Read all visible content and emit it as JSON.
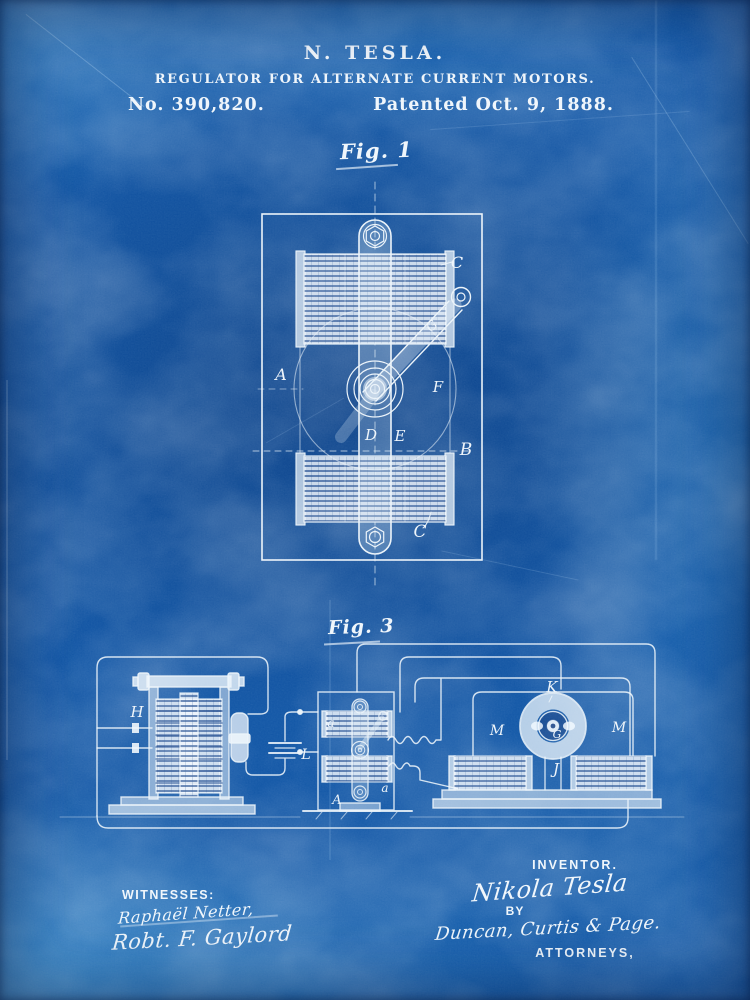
{
  "header": {
    "inventor": "N. TESLA.",
    "title": "REGULATOR FOR ALTERNATE CURRENT MOTORS.",
    "patent_number": "No. 390,820.",
    "patent_date": "Patented Oct. 9, 1888."
  },
  "fig1": {
    "caption": "Fig. 1",
    "labels": {
      "c_top": "C",
      "g": "G",
      "a": "A",
      "f": "F",
      "d": "D",
      "e": "E",
      "b": "B",
      "c_bottom": "C"
    }
  },
  "fig3": {
    "caption": "Fig. 3",
    "labels": {
      "h": "H",
      "l": "L",
      "a_top": "a",
      "a_bottom": "a",
      "a_cap": "A",
      "k": "K",
      "m_left": "M",
      "m_right": "M",
      "g": "G",
      "j": "J"
    }
  },
  "footer": {
    "witnesses_heading": "WITNESSES:",
    "witness_signature_1": "Raphaël Netter,",
    "witness_signature_2": "Robt. F. Gaylord",
    "inventor_heading": "INVENTOR.",
    "inventor_signature": "Nikola Tesla",
    "by_label": "BY",
    "attorney_signature": "Duncan, Curtis & Page.",
    "attorneys_heading": "ATTORNEYS,"
  },
  "colors": {
    "paper_blue": "#1156a6",
    "paper_light": "#4fa3d8",
    "ink_white": "#eef5fb",
    "hatch_blue": "#0f3e87"
  }
}
